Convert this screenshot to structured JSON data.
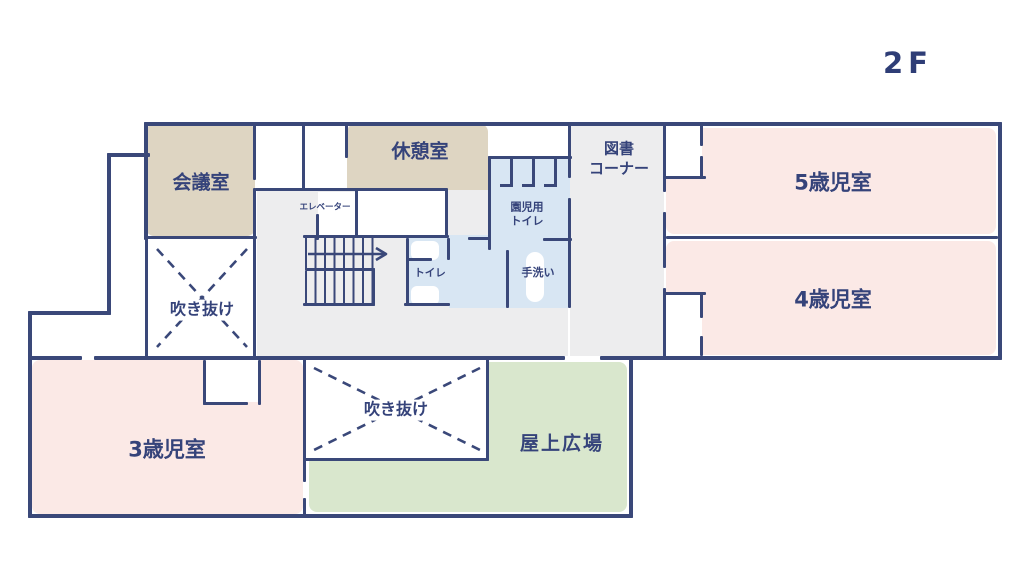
{
  "floor_label": "2F",
  "colors": {
    "wall": "#3a4879",
    "text": "#35437a",
    "meeting_break_room": "#ded5c2",
    "kids_rooms_pink": "#fbe9e6",
    "toilet_blue": "#d8e6f3",
    "rooftop_green": "#d9e7cd",
    "corridor_gray": "#ededee",
    "background": "#ffffff"
  },
  "rooms": {
    "meeting": {
      "label": "会議室"
    },
    "break": {
      "label": "休憩室"
    },
    "library": {
      "label_line1": "図書",
      "label_line2": "コーナー"
    },
    "age5": {
      "label": "5歳児室"
    },
    "age4": {
      "label": "4歳児室"
    },
    "age3": {
      "label": "3歳児室"
    },
    "rooftop": {
      "label": "屋上広場"
    },
    "void_upper": {
      "label": "吹き抜け"
    },
    "void_lower": {
      "label": "吹き抜け"
    },
    "elevator": {
      "label": "エレベーター"
    },
    "toilet": {
      "label": "トイレ"
    },
    "kids_toilet": {
      "label_line1": "園児用",
      "label_line2": "トイレ"
    },
    "handwash": {
      "label": "手洗い"
    }
  }
}
